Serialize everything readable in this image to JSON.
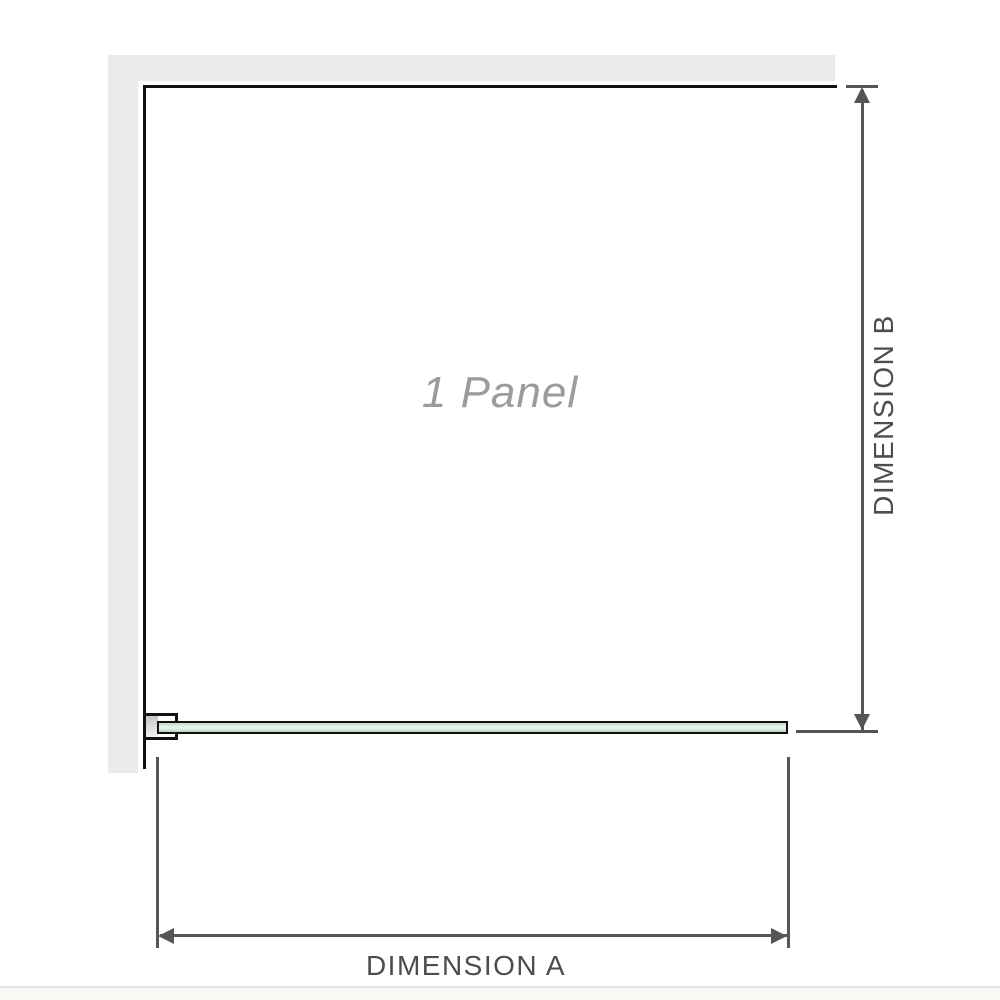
{
  "diagram": {
    "panel_label": "1 Panel",
    "dimensions": {
      "a": {
        "label": "DIMENSION A",
        "orientation": "horizontal"
      },
      "b": {
        "label": "DIMENSION B",
        "orientation": "vertical"
      }
    },
    "elements": {
      "wall": "l-shaped-wall",
      "bracket": "wall-mount-bracket",
      "glass": "glass-panel-plan-view"
    }
  },
  "colors": {
    "background": "#ffffff",
    "wall_fill": "#ebebeb",
    "frame_outline": "#111111",
    "dimension_line": "#555555",
    "dimension_label_text": "#4d4d4d",
    "panel_label_text": "#9b9b9b",
    "glass_green_light": "#e6f5ec",
    "glass_green_dark": "#a9d8bb"
  }
}
